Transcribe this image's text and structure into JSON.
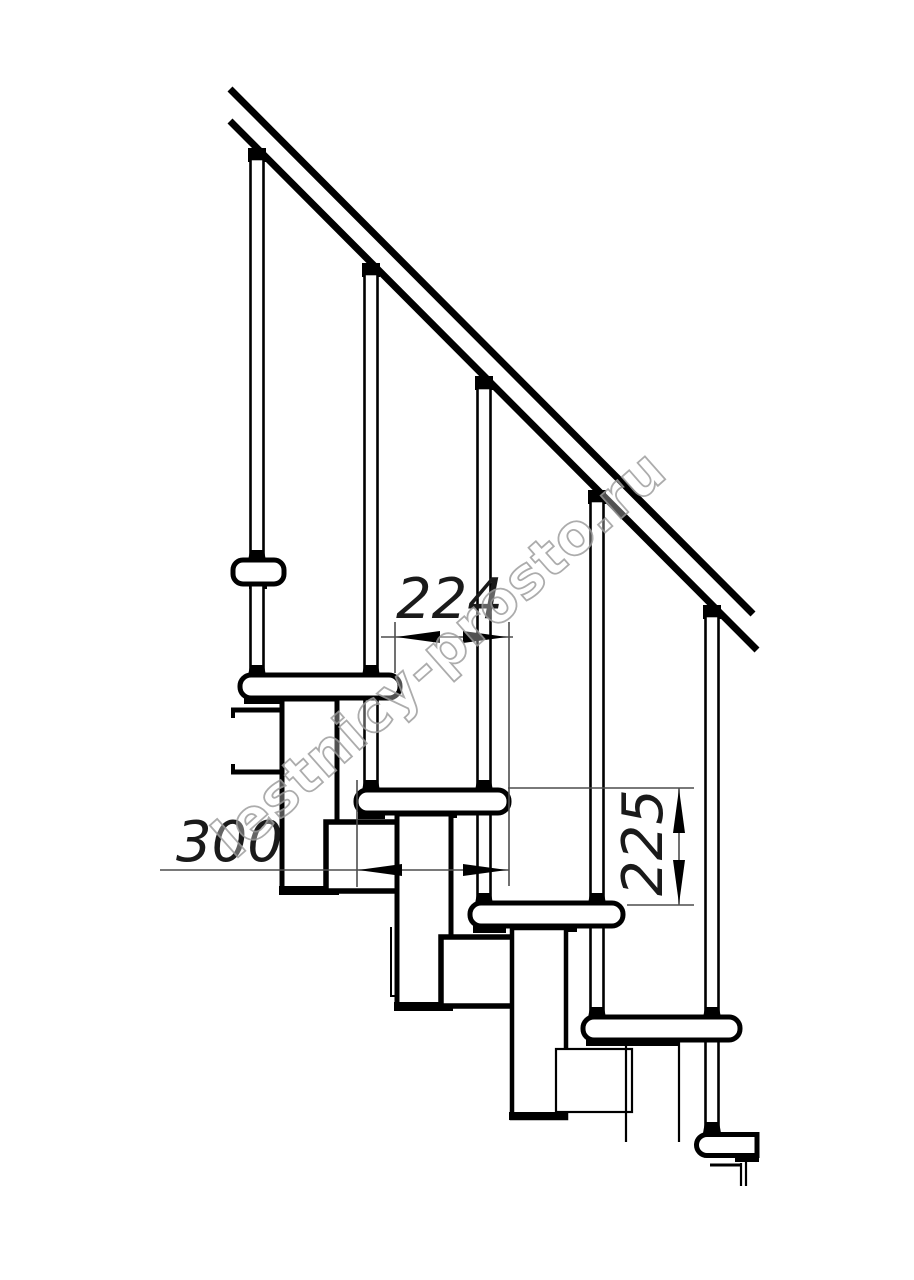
{
  "drawing": {
    "dimensions": {
      "run_label": "224",
      "depth_label": "300",
      "rise_label": "225"
    },
    "watermark": "lestnicy-prosto.ru",
    "colors": {
      "line": "#000000",
      "dim_line": "#4d4d4d",
      "watermark_stroke": "#9e9e9e"
    }
  }
}
